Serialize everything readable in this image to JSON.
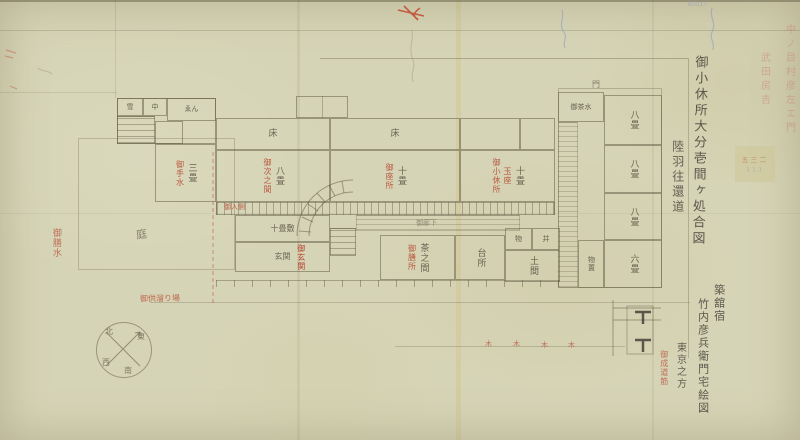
{
  "titles": {
    "main": "御小休所大分壱間ヶ処合図",
    "road": "陸羽往還道",
    "town": "築舘宿",
    "owner": "竹内彦兵衛門宅絵図",
    "direction": "東京之方",
    "route_red": "御成道筋"
  },
  "margin_notes": {
    "red_col_1": "中ノ目村彦左エ門",
    "red_col_2": "武田房吉",
    "blue_number": "65517",
    "stamp_red": "五三二",
    "stamp_blue": "113"
  },
  "compass": {
    "north": "北",
    "east": "東",
    "south": "南",
    "west": "西"
  },
  "plan": {
    "garden_label": "庭",
    "veranda_label": "御入側",
    "corridor_label": "御廊下",
    "gate_label": "門",
    "rooms": [
      {
        "label": "雪"
      },
      {
        "label": "中"
      },
      {
        "label": "ゑん"
      },
      {
        "label": "三畳",
        "red": "御手水"
      },
      {
        "label": "床"
      },
      {
        "label": "床"
      },
      {
        "label": "八畳",
        "red": "御次之間"
      },
      {
        "label": "十畳",
        "red": "御座所"
      },
      {
        "label": "十畳",
        "red": "御小休所",
        "red2": "玉座"
      },
      {
        "label": "十畳敷"
      },
      {
        "label": "玄関"
      },
      {
        "label": "茶之間",
        "red": "御膳所"
      },
      {
        "label": "台所"
      },
      {
        "label": "物"
      },
      {
        "label": "井"
      },
      {
        "label": "土間"
      },
      {
        "label": "御茶水"
      },
      {
        "label": "八畳"
      },
      {
        "label": "八畳"
      },
      {
        "label": "八畳"
      },
      {
        "label": "六畳"
      },
      {
        "label": "物置"
      }
    ],
    "annotations": {
      "water": "御膳水",
      "retinue": "御供溜り場",
      "entrance": "御玄関",
      "tree_marks": [
        "木",
        "木",
        "木",
        "木"
      ]
    }
  }
}
